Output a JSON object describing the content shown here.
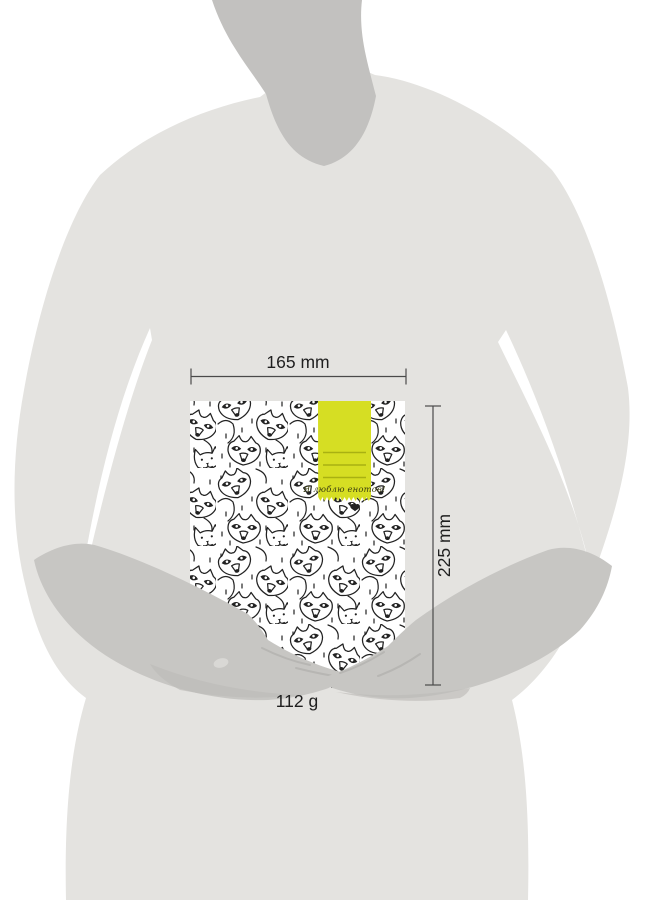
{
  "dimensions": {
    "width": "165 mm",
    "height": "225 mm",
    "weight": "112 g"
  },
  "cover": {
    "label_text": "Я люблю енотов!",
    "pattern": "raccoon-doodle-pattern"
  },
  "colors": {
    "accent": "#d6de23",
    "accent_line": "#a9b112",
    "body": "#e4e3e0",
    "neck": "#c2c1bf",
    "skin": "#c7c6c3",
    "shadow": "#b7b6b3",
    "soft_shadow": "#bdbcb9",
    "nail": "#d9d8d5",
    "paper": "#ffffff",
    "doodle": "#222222",
    "line": "#4a4a4a",
    "ink": "#1f1f1f"
  }
}
